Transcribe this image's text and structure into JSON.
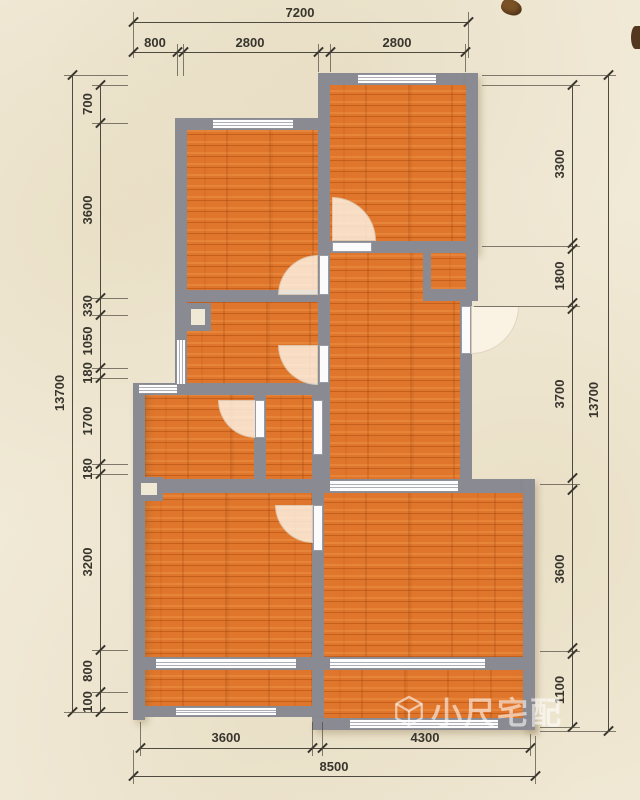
{
  "plan": {
    "watermark": "小尺宅配",
    "colors": {
      "paper": "#f1ead7",
      "wall": "#8a8a92",
      "floor": "#e0762b",
      "dimension_text": "#38352d",
      "window": "#fdfdfd"
    }
  },
  "dims": {
    "top": {
      "total": "7200",
      "segments": [
        "800",
        "2800",
        "2800"
      ]
    },
    "left": {
      "total": "13700",
      "segments": [
        "700",
        "3600",
        "330",
        "1050",
        "180",
        "1700",
        "180",
        "3200",
        "800",
        "100"
      ]
    },
    "right": {
      "total": "13700",
      "segments": [
        "3300",
        "1800",
        "3700",
        "3600",
        "1100"
      ]
    },
    "bottom": {
      "total": "8500",
      "segments": [
        "3600",
        "4300"
      ]
    }
  }
}
